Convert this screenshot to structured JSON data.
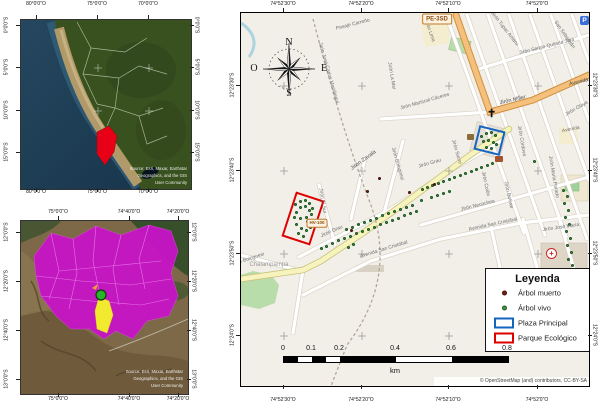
{
  "peru_inset": {
    "top_axis": [
      {
        "t": "80°0'0\"O",
        "x": 36
      },
      {
        "t": "75°0'0\"O",
        "x": 97
      },
      {
        "t": "70°0'0\"O",
        "x": 148
      }
    ],
    "left_axis": [
      {
        "t": "0°0'0\"S",
        "y": 25
      },
      {
        "t": "5°0'0\"S",
        "y": 67
      },
      {
        "t": "10°0'0\"S",
        "y": 110
      },
      {
        "t": "15°0'0\"S",
        "y": 152
      }
    ],
    "attribution": [
      "Source: Esri, Maxar, Earthstar",
      "Geographics, and the GIS",
      "User Community"
    ],
    "highlight_color": "#e80016"
  },
  "region_inset": {
    "top_axis": [
      {
        "t": "75°0'0\"O",
        "x": 58
      },
      {
        "t": "74°40'0\"O",
        "x": 129
      },
      {
        "t": "74°20'0\"O",
        "x": 178
      }
    ],
    "left_axis": [
      {
        "t": "12°0'0\"S",
        "y": 232
      },
      {
        "t": "12°20'0\"S",
        "y": 281
      },
      {
        "t": "12°40'0\"S",
        "y": 330
      },
      {
        "t": "13°0'0\"S",
        "y": 379
      }
    ],
    "attribution": [
      "Source: Esri, Maxar, Earthstar",
      "Geographics, and the GIS",
      "User Community"
    ],
    "province_color": "#c714c7",
    "district_color": "#f2ea2f",
    "marker_color": "#28b428"
  },
  "main_map": {
    "top_axis": [
      {
        "t": "74°52'30\"O",
        "x": 283
      },
      {
        "t": "74°52'20\"O",
        "x": 361
      },
      {
        "t": "74°52'10\"O",
        "x": 448
      },
      {
        "t": "74°52'0\"O",
        "x": 537
      }
    ],
    "left_axis": [
      {
        "t": "12°23'30\"S",
        "y": 85
      },
      {
        "t": "12°23'40\"S",
        "y": 170
      },
      {
        "t": "12°23'50\"S",
        "y": 253
      },
      {
        "t": "12°24'0\"S",
        "y": 335
      }
    ],
    "compass": {
      "n": "N",
      "e": "E",
      "s": "S",
      "w": "O"
    },
    "icons": {
      "church": "✝",
      "hospital": "+",
      "parking": "P"
    },
    "shields": [
      {
        "t": "PE-3SD",
        "x": 436,
        "y": 18
      },
      {
        "t": "HV-100",
        "x": 316,
        "y": 222
      }
    ],
    "streets": [
      {
        "t": "Pasaje Carreño",
        "x": 352,
        "y": 24,
        "r": -14
      },
      {
        "t": "Jirón José Carlos Mariátegui",
        "x": 327,
        "y": 72,
        "r": 74
      },
      {
        "t": "Jirón La Mar",
        "x": 390,
        "y": 75,
        "r": 80
      },
      {
        "t": "Jirón Mariscal Cáceres",
        "x": 424,
        "y": 101,
        "r": -16
      },
      {
        "t": "Jirón Tupac Amaru",
        "x": 503,
        "y": 28,
        "r": 52
      },
      {
        "t": "Jirón Sergio Quijada Jara",
        "x": 546,
        "y": 46,
        "r": -14
      },
      {
        "t": "Jirón Miller",
        "x": 512,
        "y": 100,
        "r": -13,
        "s": 5.5,
        "c": "#4f4f4f"
      },
      {
        "t": "Avenida",
        "x": 578,
        "y": 82,
        "r": -14,
        "s": 5.5,
        "c": "#4f4f4f"
      },
      {
        "t": "Jirón Olaya",
        "x": 576,
        "y": 108,
        "r": -30
      },
      {
        "t": "Avenida",
        "x": 570,
        "y": 129,
        "r": -12
      },
      {
        "t": "Jirón Córdova",
        "x": 520,
        "y": 140,
        "r": 80
      },
      {
        "t": "Jirón Sucre",
        "x": 455,
        "y": 151,
        "r": 74
      },
      {
        "t": "Jirón Lima",
        "x": 428,
        "y": 30,
        "r": 70
      },
      {
        "t": "Jirón Grau",
        "x": 429,
        "y": 163,
        "r": -16
      },
      {
        "t": "Jirón Grau",
        "x": 331,
        "y": 231,
        "r": -24
      },
      {
        "t": "Jirón Colón",
        "x": 484,
        "y": 183,
        "r": 78
      },
      {
        "t": "Jirón Bolívar",
        "x": 507,
        "y": 194,
        "r": 78
      },
      {
        "t": "Jirón Necochea",
        "x": 477,
        "y": 205,
        "r": -14
      },
      {
        "t": "Avenida San Cristóbal",
        "x": 492,
        "y": 224,
        "r": -12
      },
      {
        "t": "Avenida San Cristóbal",
        "x": 383,
        "y": 249,
        "r": -17
      },
      {
        "t": "Jirón José María",
        "x": 560,
        "y": 227,
        "r": -8
      },
      {
        "t": "Jirón María Parado",
        "x": 552,
        "y": 176,
        "r": 80
      },
      {
        "t": "Jirón Zavala",
        "x": 363,
        "y": 160,
        "r": -36,
        "s": 5.5,
        "c": "#4f4f4f"
      },
      {
        "t": "Jirón El Sur",
        "x": 321,
        "y": 200,
        "r": 80
      },
      {
        "t": "Jirón Bolognesi",
        "x": 396,
        "y": 163,
        "r": 74
      },
      {
        "t": "Jirón Bolognesi",
        "x": 247,
        "y": 259,
        "r": -18
      },
      {
        "t": "San Sebastián",
        "x": 563,
        "y": 34,
        "r": 55
      }
    ],
    "place_labels": [
      {
        "t": "Chalampampa",
        "x": 268,
        "y": 264,
        "s": 6,
        "c": "#9a9a9a"
      }
    ],
    "attribution": "© OpenStreetMap (and) contributors, CC-BY-SA",
    "scalebar": {
      "ticks": [
        "0",
        "0.1",
        "0.2",
        "0.4",
        "0.6",
        "0.8"
      ],
      "unit": "km"
    },
    "legend": {
      "title": "Leyenda",
      "items": [
        {
          "label": "Árbol muerto",
          "symbol": "dot",
          "color": "#7b1d12"
        },
        {
          "label": "Árbol vivo",
          "symbol": "dot",
          "color": "#3f9b3f"
        },
        {
          "label": "Plaza Principal",
          "symbol": "rect",
          "color": "#1565c0"
        },
        {
          "label": "Parque Ecológico",
          "symbol": "rect",
          "color": "#df0000"
        }
      ]
    },
    "trees": {
      "alive": [
        [
          294,
          203
        ],
        [
          299,
          200
        ],
        [
          304,
          199
        ],
        [
          308,
          202
        ],
        [
          311,
          207
        ],
        [
          310,
          213
        ],
        [
          305,
          216
        ],
        [
          299,
          217
        ],
        [
          295,
          211
        ],
        [
          299,
          206
        ],
        [
          304,
          205
        ],
        [
          308,
          209
        ],
        [
          295,
          223
        ],
        [
          300,
          227
        ],
        [
          305,
          229
        ],
        [
          309,
          226
        ],
        [
          302,
          235
        ],
        [
          297,
          232
        ],
        [
          306,
          220
        ],
        [
          293,
          216
        ],
        [
          480,
          135
        ],
        [
          485,
          132
        ],
        [
          490,
          131
        ],
        [
          494,
          134
        ],
        [
          482,
          140
        ],
        [
          487,
          139
        ],
        [
          492,
          141
        ],
        [
          485,
          146
        ],
        [
          490,
          147
        ],
        [
          495,
          143
        ],
        [
          320,
          247
        ],
        [
          325,
          245
        ],
        [
          331,
          242
        ],
        [
          337,
          239
        ],
        [
          343,
          237
        ],
        [
          349,
          235
        ],
        [
          355,
          232
        ],
        [
          361,
          230
        ],
        [
          367,
          228
        ],
        [
          373,
          226
        ],
        [
          379,
          223
        ],
        [
          385,
          221
        ],
        [
          391,
          219
        ],
        [
          397,
          217
        ],
        [
          403,
          214
        ],
        [
          409,
          212
        ],
        [
          415,
          210
        ],
        [
          345,
          228
        ],
        [
          351,
          226
        ],
        [
          357,
          223
        ],
        [
          363,
          221
        ],
        [
          369,
          219
        ],
        [
          375,
          217
        ],
        [
          381,
          214
        ],
        [
          387,
          212
        ],
        [
          393,
          210
        ],
        [
          399,
          208
        ],
        [
          405,
          206
        ],
        [
          411,
          204
        ],
        [
          421,
          188
        ],
        [
          426,
          186
        ],
        [
          431,
          184
        ],
        [
          437,
          182
        ],
        [
          442,
          180
        ],
        [
          448,
          178
        ],
        [
          453,
          176
        ],
        [
          459,
          174
        ],
        [
          464,
          172
        ],
        [
          470,
          170
        ],
        [
          475,
          168
        ],
        [
          480,
          166
        ],
        [
          486,
          164
        ],
        [
          491,
          162
        ],
        [
          430,
          196
        ],
        [
          436,
          194
        ],
        [
          442,
          192
        ],
        [
          448,
          190
        ],
        [
          533,
          160
        ],
        [
          352,
          243
        ],
        [
          347,
          246
        ],
        [
          420,
          199
        ],
        [
          562,
          189
        ],
        [
          566,
          195
        ],
        [
          563,
          202
        ],
        [
          567,
          209
        ],
        [
          564,
          216
        ],
        [
          568,
          223
        ],
        [
          565,
          230
        ],
        [
          569,
          237
        ],
        [
          566,
          244
        ],
        [
          570,
          251
        ],
        [
          567,
          258
        ],
        [
          571,
          264
        ],
        [
          590,
          97
        ]
      ],
      "dead": [
        [
          366,
          190
        ],
        [
          378,
          177
        ],
        [
          433,
          183
        ],
        [
          350,
          229
        ],
        [
          408,
          191
        ]
      ]
    }
  }
}
